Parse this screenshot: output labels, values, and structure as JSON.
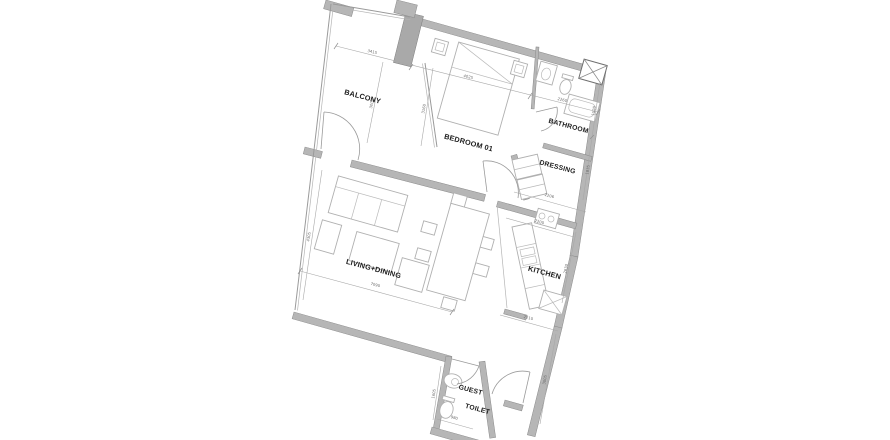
{
  "plan": {
    "type": "apartment-floor-plan",
    "colors": {
      "background": "#ffffff",
      "wall": "#b6b6b6",
      "wall_dark": "#a9a9a9",
      "line": "#9a9a9a",
      "label": "#1c1c1c",
      "dimension": "#6b6b6b"
    },
    "symbols": [
      "bed-icon",
      "nightstand-icon",
      "sofa-icon",
      "coffee-table-icon",
      "armchair-icon",
      "dining-table-icon",
      "chair-icon",
      "stove-icon",
      "kitchen-counter-icon",
      "fridge-icon",
      "wardrobe-icon",
      "washbasin-icon",
      "toilet-icon",
      "bathtub-icon",
      "shaft-icon",
      "door-swing-icon"
    ],
    "rooms": {
      "balcony": {
        "label": "BALCONY",
        "dim_width": "3415",
        "dim_depth": "3005"
      },
      "bedroom": {
        "label": "BEDROOM 01",
        "dim_width": "4025",
        "dim_depth": "3160"
      },
      "bathroom": {
        "label": "BATHROOM",
        "dim_width": "2260",
        "dim_depth": "1520"
      },
      "dressing": {
        "label": "DRESSING",
        "dim_width": "2206",
        "dim_depth": "1835"
      },
      "kitchen": {
        "label": "KITCHEN",
        "dim_width_top": "2200",
        "dim_width_bottom": "2210",
        "dim_depth": "2630"
      },
      "living_dining": {
        "label": "LIVING+DINING",
        "dim_width": "7090",
        "dim_depth": "4305"
      },
      "guest_toilet": {
        "label_line1": "GUEST",
        "label_line2": "TOILET",
        "dim_width": "980",
        "dim_depth": "1605"
      },
      "hallway": {
        "dim_depth": "3005"
      }
    }
  }
}
